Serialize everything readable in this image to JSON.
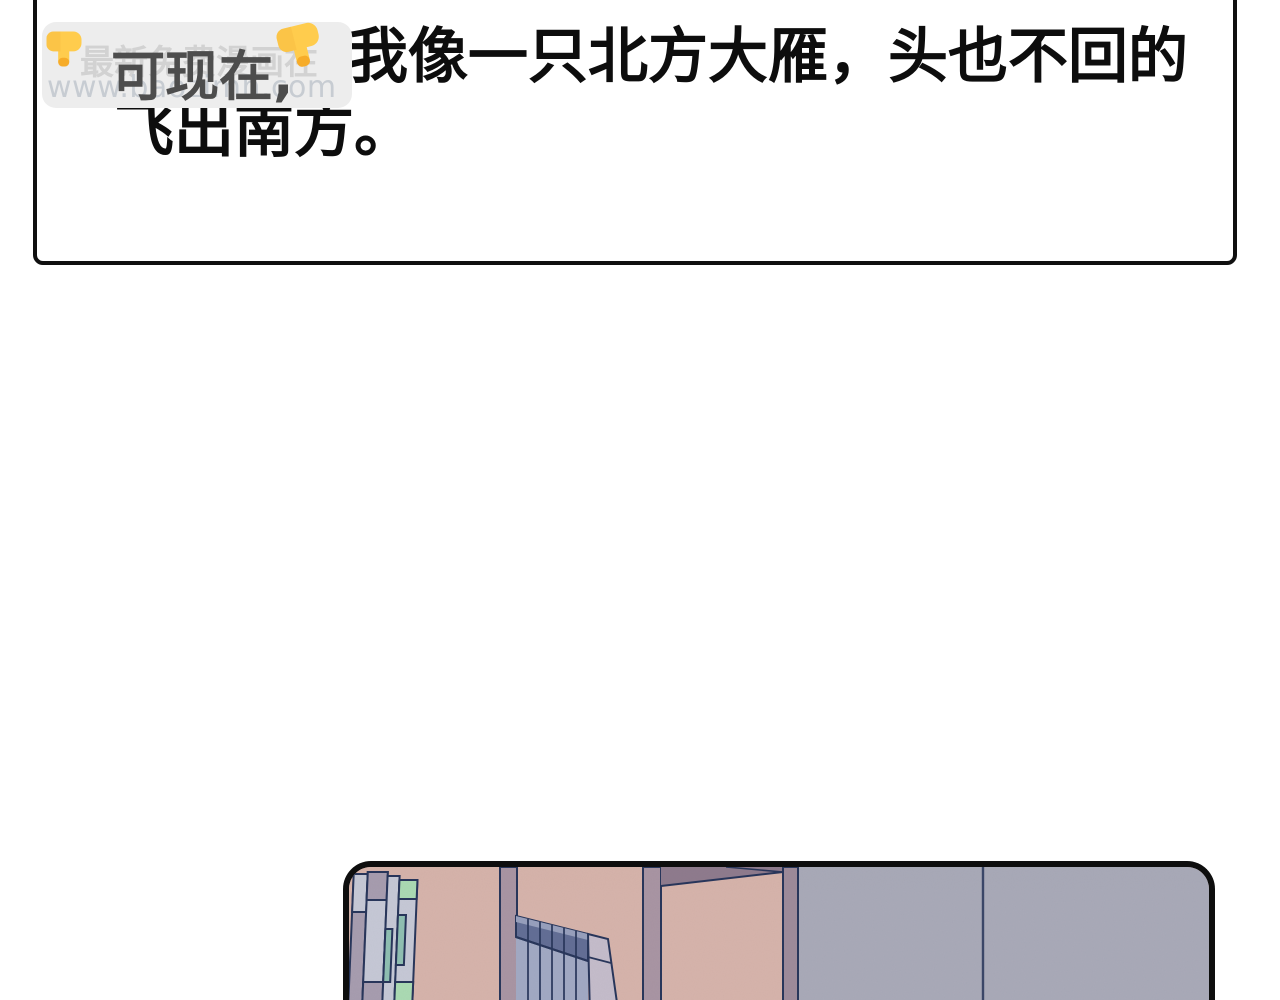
{
  "caption": {
    "prefix": "可现在,",
    "line1": "我像一只北方大雁，头也不回的",
    "line2": "飞出南方。",
    "pointer_emoji": "👇"
  },
  "watermark": {
    "title": "最新免费漫画在",
    "url": "www.baozimh.com"
  },
  "icons": {
    "pointer_down_left": "point-down-emoji",
    "pointer_down_right": "point-down-emoji"
  },
  "colors": {
    "ink": "#101010",
    "hidden-text": "#4d4d4d",
    "watermark-bg": "#ededed",
    "watermark-text": "#d2d2d2",
    "watermark-url": "#c7ccd2",
    "panel-border": "#0e0e0e",
    "shelf-pink": "#d7b4ab",
    "wall-gray": "#a9aab8",
    "pole-mauve": "#a995a3",
    "pole-dark": "#9e8b9a",
    "shelf-top-dark": "#8f7b8d",
    "outline-navy": "#27355a",
    "book-light": "#c6c9d6",
    "book-mauve": "#a79daf",
    "book-mint": "#abdbb3",
    "book-teal": "#8fc0b2",
    "book-cap": "#626e95",
    "book-cap-light": "#97a0bd",
    "book-body": "#a2aac4",
    "book-pale": "#c5bdcb",
    "emoji-yellow": "#ffcc4d",
    "emoji-shade": "#f5a623"
  }
}
